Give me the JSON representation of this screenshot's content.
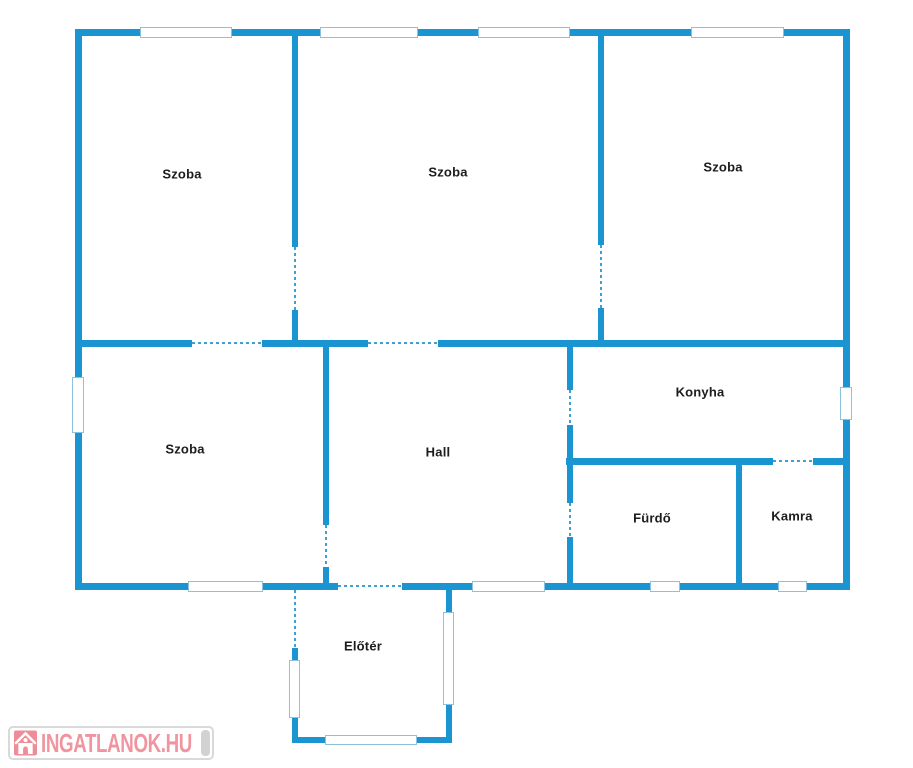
{
  "colors": {
    "wall": "#1b95d2",
    "window_border": "#8fc1dc",
    "door_dash": "#3f9fd4",
    "label_text": "#1c1c1c",
    "watermark_border": "#d9d9d9",
    "watermark_bg": "#ffffff",
    "watermark_text": "#f0959f",
    "watermark_logo": "#ee8c98",
    "watermark_pill": "#d2d2d2"
  },
  "rooms": [
    {
      "label": "Szoba",
      "x": 182,
      "y": 174
    },
    {
      "label": "Szoba",
      "x": 448,
      "y": 172
    },
    {
      "label": "Szoba",
      "x": 723,
      "y": 167
    },
    {
      "label": "Szoba",
      "x": 185,
      "y": 449
    },
    {
      "label": "Hall",
      "x": 438,
      "y": 452
    },
    {
      "label": "Konyha",
      "x": 700,
      "y": 392
    },
    {
      "label": "Fürdő",
      "x": 652,
      "y": 518
    },
    {
      "label": "Kamra",
      "x": 792,
      "y": 516
    },
    {
      "label": "Előtér",
      "x": 363,
      "y": 646
    }
  ],
  "watermark": {
    "text": "INGATLANOK.HU"
  },
  "geometry": {
    "walls": [
      [
        75,
        29,
        775,
        7
      ],
      [
        75,
        29,
        7,
        561
      ],
      [
        843,
        29,
        7,
        561
      ],
      [
        75,
        340,
        117,
        7
      ],
      [
        262,
        340,
        106,
        7
      ],
      [
        438,
        340,
        412,
        7
      ],
      [
        566,
        458,
        207,
        7
      ],
      [
        813,
        458,
        37,
        7
      ],
      [
        75,
        583,
        263,
        7
      ],
      [
        402,
        583,
        448,
        7
      ],
      [
        292,
        36,
        6,
        211
      ],
      [
        292,
        310,
        6,
        31
      ],
      [
        598,
        36,
        6,
        209
      ],
      [
        598,
        308,
        6,
        33
      ],
      [
        323,
        347,
        6,
        178
      ],
      [
        323,
        567,
        6,
        17
      ],
      [
        567,
        345,
        6,
        45
      ],
      [
        567,
        425,
        6,
        78
      ],
      [
        567,
        537,
        6,
        47
      ],
      [
        736,
        458,
        6,
        126
      ],
      [
        292,
        648,
        6,
        95
      ],
      [
        446,
        585,
        6,
        158
      ],
      [
        292,
        737,
        160,
        6
      ]
    ],
    "windows": [
      [
        140,
        27,
        92,
        11
      ],
      [
        320,
        27,
        98,
        11
      ],
      [
        478,
        27,
        92,
        11
      ],
      [
        691,
        27,
        93,
        11
      ],
      [
        72,
        377,
        12,
        56
      ],
      [
        840,
        387,
        12,
        33
      ],
      [
        188,
        581,
        75,
        11
      ],
      [
        472,
        581,
        73,
        11
      ],
      [
        650,
        581,
        30,
        11
      ],
      [
        778,
        581,
        29,
        11
      ],
      [
        289,
        660,
        11,
        58
      ],
      [
        443,
        612,
        11,
        93
      ],
      [
        325,
        735,
        92,
        10
      ]
    ],
    "doors": [
      {
        "o": "h",
        "x": 192,
        "y": 342,
        "len": 70
      },
      {
        "o": "h",
        "x": 368,
        "y": 342,
        "len": 70
      },
      {
        "o": "h",
        "x": 338,
        "y": 585,
        "len": 64
      },
      {
        "o": "h",
        "x": 773,
        "y": 460,
        "len": 40
      },
      {
        "o": "v",
        "x": 294,
        "y": 247,
        "len": 63
      },
      {
        "o": "v",
        "x": 600,
        "y": 245,
        "len": 63
      },
      {
        "o": "v",
        "x": 325,
        "y": 525,
        "len": 42
      },
      {
        "o": "v",
        "x": 569,
        "y": 390,
        "len": 35
      },
      {
        "o": "v",
        "x": 569,
        "y": 503,
        "len": 34
      },
      {
        "o": "v",
        "x": 294,
        "y": 590,
        "len": 58
      }
    ]
  }
}
